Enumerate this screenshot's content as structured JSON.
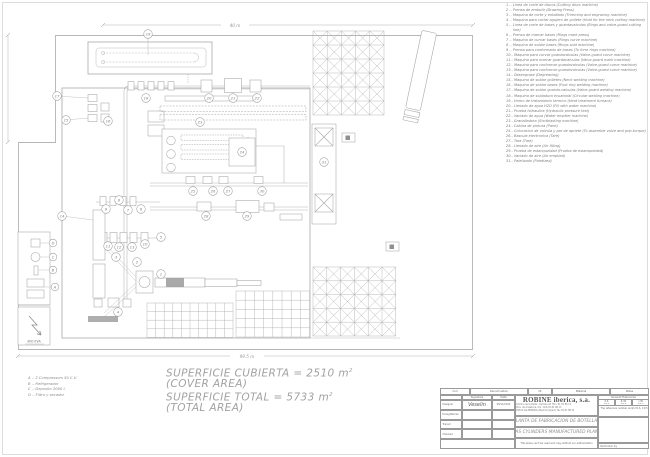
{
  "legend": {
    "items": [
      "1 .- Linea de corte de discos (Cutting discs machine)",
      "2 .- Prensa de embutir (Drawing Press)",
      "3 .- Maquina de corte y entallado (Trimming and engraving machine)",
      "4 .- Maquina para cortar agujero de gollete (Hold for the neck cutting machine)",
      "5 .- Linea de corte de bases y guardavalvulas (Rings and valve-guard cutting line)",
      "6 .- Prensa de marcar bases (Rings mark press)",
      "7 .- Maquina de curvar bases (Rings curve machine)",
      "8 .- Maquina de soldar bases (Rings sold machine)",
      "9 .- Prensa para conformado de bases (To form rings machine)",
      "10.- Maquina para curvar guardavalvulas (Valve-guard curve machine)",
      "11.- Maquina para marcar guardavalvulas (Valve-guard mark machine)",
      "12.- Maquina para conformar guardavalvulas (Valve-guard curve machine)",
      "13.- Maquina para conformar guardavalvulas (Valve-guard curve machine)",
      "14.- Desengrase (Degreasing)",
      "15.- Maquina de soldar golletes (Neck welding machine)",
      "16.- Maquina de soldar bases (Foot ring welding machine)",
      "17.- Maquina de soldar guarda-valvulas (Valve-guard welding machine)",
      "18.- Maquina de soldadura ecuatorial (Circular welding machine)",
      "19.- Horno de tratamiento termico (Heat treatment furnace)",
      "20.- Llenado de agua H2O (Fill with water machine)",
      "21.- Prueba hidraulica (Hydraulic pressure test)",
      "22.- Vaciado de agua (Water emptier machine)",
      "23.- Granalladora (Shotblasting machine)",
      "24.- Cabina de pintura (Paint)",
      "25.- Colocacion de valvula y par de apriete (To assemble valve and grip-torque)",
      "26.- Bascula electronica (Tare)",
      "27.- Tara (Tare)",
      "28.- Llenado de aire (Air filling)",
      "29.- Prueba de estanqueidad (Prueba de estanqueidad)",
      "30.- Vaciado de aire (Air emptied)",
      "31.- Paletizado (Paletized)"
    ]
  },
  "aux_legend": {
    "items": [
      "A .- 2 Compressors 50 C.V.",
      "B .- Refrigerador",
      "C .- Deposito 2000 l.",
      "D .- Filtro y secador"
    ]
  },
  "areas": {
    "covered_es": "SUPERFICIE CUBIERTA = 2510 m",
    "covered_sup": "2",
    "covered_en": "(COVER AREA)",
    "total_es": "SUPERFICIE TOTAL = 5733 m",
    "total_sup": "2",
    "total_en": "(TOTAL AREA)"
  },
  "dimensions": {
    "top": "40 m",
    "bottom": "99.5 m"
  },
  "plan": {
    "transformer_label": "800 KVA",
    "stations": [
      {
        "n": "1",
        "x": 161,
        "y": 274
      },
      {
        "n": "2",
        "x": 137,
        "y": 262
      },
      {
        "n": "3",
        "x": 116,
        "y": 257
      },
      {
        "n": "4",
        "x": 118,
        "y": 312
      },
      {
        "n": "5",
        "x": 161,
        "y": 237
      },
      {
        "n": "6",
        "x": 141,
        "y": 209
      },
      {
        "n": "7",
        "x": 128,
        "y": 210
      },
      {
        "n": "8",
        "x": 119,
        "y": 200
      },
      {
        "n": "9",
        "x": 106,
        "y": 209
      },
      {
        "n": "10",
        "x": 145,
        "y": 244
      },
      {
        "n": "11",
        "x": 108,
        "y": 246
      },
      {
        "n": "12",
        "x": 119,
        "y": 247
      },
      {
        "n": "13",
        "x": 132,
        "y": 247
      },
      {
        "n": "14",
        "x": 62,
        "y": 216
      },
      {
        "n": "15",
        "x": 66,
        "y": 120
      },
      {
        "n": "16",
        "x": 108,
        "y": 121
      },
      {
        "n": "17",
        "x": 57,
        "y": 96
      },
      {
        "n": "18",
        "x": 146,
        "y": 98
      },
      {
        "n": "19",
        "x": 148,
        "y": 34
      },
      {
        "n": "20",
        "x": 209,
        "y": 98
      },
      {
        "n": "21",
        "x": 233,
        "y": 98
      },
      {
        "n": "22",
        "x": 257,
        "y": 98
      },
      {
        "n": "23",
        "x": 200,
        "y": 122
      },
      {
        "n": "24",
        "x": 242,
        "y": 152
      },
      {
        "n": "25",
        "x": 193,
        "y": 191
      },
      {
        "n": "26",
        "x": 213,
        "y": 191
      },
      {
        "n": "27",
        "x": 228,
        "y": 191
      },
      {
        "n": "28",
        "x": 206,
        "y": 216
      },
      {
        "n": "29",
        "x": 247,
        "y": 216
      },
      {
        "n": "30",
        "x": 262,
        "y": 191
      },
      {
        "n": "31",
        "x": 324,
        "y": 162
      }
    ],
    "rooms": [
      {
        "n": "D",
        "x": 53,
        "y": 243
      },
      {
        "n": "C",
        "x": 53,
        "y": 257
      },
      {
        "n": "B",
        "x": 53,
        "y": 270
      },
      {
        "n": "A",
        "x": 55,
        "y": 287
      }
    ],
    "grids": [
      {
        "x": 147,
        "y": 303,
        "cols": 10,
        "rows": 4,
        "cw": 8.6,
        "ch": 8.6,
        "cross": false
      },
      {
        "x": 236,
        "y": 291,
        "cols": 8,
        "rows": 5,
        "cw": 9.2,
        "ch": 9.2,
        "cross": false
      },
      {
        "x": 313,
        "y": 31,
        "cols": 5,
        "rows": 6,
        "cw": 14.2,
        "ch": 14,
        "cross": true
      },
      {
        "x": 313,
        "y": 267,
        "cols": 6,
        "rows": 5,
        "cw": 13.8,
        "ch": 13.8,
        "cross": true
      }
    ]
  },
  "titleblock": {
    "rev_headers": [
      "Cod",
      "Denomination",
      "Qt",
      "Material",
      "Notes"
    ],
    "sign": {
      "signature_header": "Signature",
      "date_header": "Date",
      "labels": [
        "Designer",
        "Draughtsman",
        "Traced",
        "Checked"
      ],
      "signature": "Veselin",
      "date": "28/11/2012"
    },
    "company": {
      "name": "ROBINE iberica, s.a.",
      "addr1": "Camino de la Zarza - Parcela 44   Tfno. 91 81 88 13",
      "addr2": "Ctra. de Andalucia, Km. 19,8            91 81 88 13",
      "addr3": "28342 VALDEMORO (Madrid) (Spain)  Fax 91 81 88 21"
    },
    "titles": {
      "es": "PLANTA DE FABRICACION DE BOTELLAS",
      "en": "GAS CYLINDERS MANUFACTURED PLANT"
    },
    "tolerances": {
      "header": "General Tolerances",
      "ranges": [
        "0-6",
        "6-30",
        ">30"
      ],
      "values": [
        "±0.1",
        "±0.2",
        "±0.5"
      ],
      "note": "The reference number and/or R.S. ±0.5"
    },
    "notes": {
      "usage": "This plane can't be used and copy without our authorization",
      "reminder": "Reminder by"
    }
  }
}
